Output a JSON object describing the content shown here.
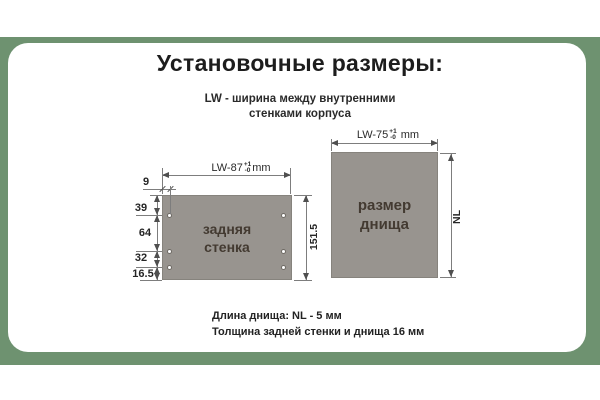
{
  "colors": {
    "band_green": "#6e9270",
    "card_white": "#ffffff",
    "panel_gray": "#98948f",
    "dim_line_gray": "#7d7d7d",
    "text_dark": "#1d1d1d"
  },
  "header": {
    "title": "Установочные размеры:"
  },
  "legend": {
    "line1": "LW -  ширина между внутренними",
    "line2": "стенками корпуса"
  },
  "back_wall": {
    "label_line1": "задняя",
    "label_line2": "стенка",
    "width_dim": {
      "prefix": "LW-87",
      "tol_plus": "+1",
      "tol_minus": "-0",
      "suffix": "mm"
    },
    "height_total": "151.5",
    "hole_offset": "9",
    "segments": [
      "39",
      "64",
      "32",
      "16.5"
    ]
  },
  "bottom_panel": {
    "label_line1": "размер",
    "label_line2": "днища",
    "width_dim": {
      "prefix": "LW-75",
      "tol_plus": "+1",
      "tol_minus": "-0",
      "suffix": "mm"
    },
    "height_dim": "NL"
  },
  "notes": {
    "line1": "Длина днища: NL - 5  мм",
    "line2": "Толщина задней стенки и днища 16 мм"
  }
}
